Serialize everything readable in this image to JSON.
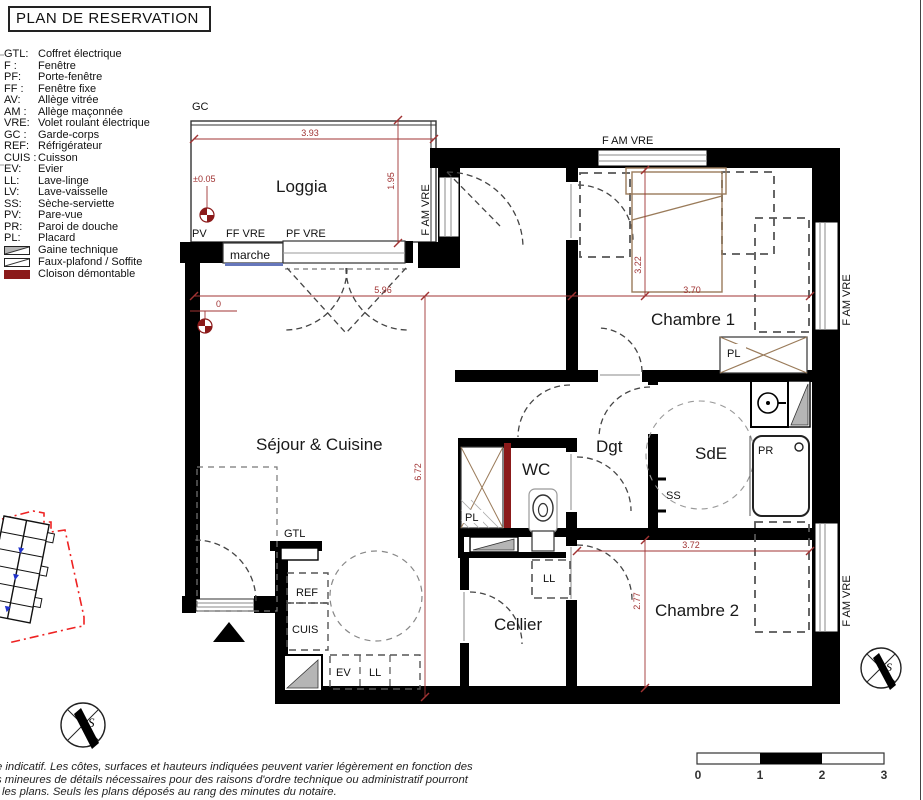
{
  "title": "PLAN DE RESERVATION",
  "legend": {
    "entries": [
      {
        "abbr": "GTL:",
        "label": "Coffret électrique"
      },
      {
        "abbr": "F :",
        "label": "Fenêtre"
      },
      {
        "abbr": "PF:",
        "label": "Porte-fenêtre"
      },
      {
        "abbr": "FF :",
        "label": "Fenêtre fixe"
      },
      {
        "abbr": "AV:",
        "label": "Allège vitrée"
      },
      {
        "abbr": "AM :",
        "label": "Allège maçonnée"
      },
      {
        "abbr": "VRE:",
        "label": "Volet roulant électrique"
      },
      {
        "abbr": "GC :",
        "label": "Garde-corps"
      },
      {
        "abbr": "REF:",
        "label": "Réfrigérateur"
      },
      {
        "abbr": "CUIS :",
        "label": "Cuisson"
      },
      {
        "abbr": "EV:",
        "label": "Evier"
      },
      {
        "abbr": "LL:",
        "label": "Lave-linge"
      },
      {
        "abbr": "LV:",
        "label": "Lave-vaisselle"
      },
      {
        "abbr": "SS:",
        "label": "Sèche-serviette"
      },
      {
        "abbr": "PV:",
        "label": "Pare-vue"
      },
      {
        "abbr": "PR:",
        "label": "Paroi de douche"
      },
      {
        "abbr": "PL:",
        "label": "Placard"
      }
    ],
    "swatches": [
      {
        "label": "Gaine technique"
      },
      {
        "label": "Faux-plafond / Soffite"
      },
      {
        "label": "Cloison démontable"
      }
    ]
  },
  "plan": {
    "rooms": {
      "loggia": "Loggia",
      "chambre1": "Chambre 1",
      "sejour": "Séjour & Cuisine",
      "wc": "WC",
      "dgt": "Dgt",
      "sde": "SdE",
      "cellier": "Cellier",
      "chambre2": "Chambre 2"
    },
    "labels": {
      "gc": "GC",
      "pv": "PV",
      "ff_vre": "FF VRE",
      "pf_vre": "PF VRE",
      "marche": "marche",
      "f_am_vre": "F AM VRE",
      "pl": "PL",
      "ss": "SS",
      "pr": "PR",
      "gtl": "GTL",
      "ref": "REF",
      "cuis": "CUIS",
      "ev": "EV",
      "ll": "LL",
      "level_loggia": "±0.05",
      "level_zero": "0"
    },
    "dims": {
      "d393": "3.93",
      "d195": "1.95",
      "d596": "5.96",
      "d370": "3.70",
      "d322": "3.22",
      "d672": "6.72",
      "d372": "3.72",
      "d277": "2.77"
    }
  },
  "compass": {
    "letter": "S"
  },
  "scalebar": {
    "t0": "0",
    "t1": "1",
    "t2": "2",
    "t3": "3"
  },
  "disclaimer": {
    "line1": "e indicatif. Les côtes, surfaces et hauteurs indiquées peuvent varier légèrement en fonction des",
    "line2": "s mineures de détails nécessaires pour des raisons d'ordre technique ou administratif pourront",
    "line3": "les plans. Seuls les plans déposés au rang des minutes du notaire."
  },
  "colors": {
    "wall": "#000000",
    "dim": "#a03333",
    "cloison": "#8b1a1a",
    "gaine": "#b5b5b5",
    "furniture_tan": "#9a7b5a",
    "minimap_red": "#ee2222",
    "marche_blue": "#6677bb"
  }
}
